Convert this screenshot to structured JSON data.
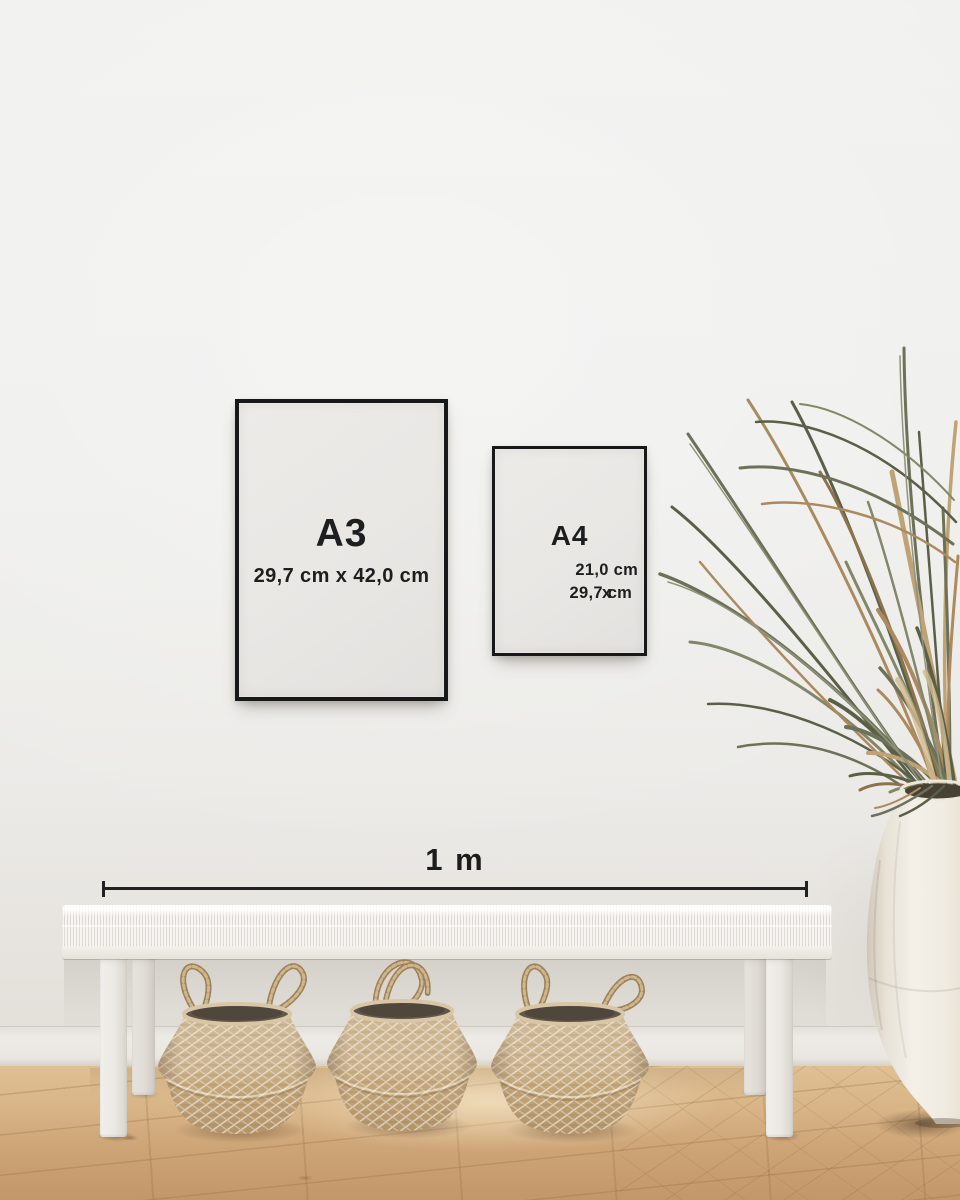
{
  "page": {
    "type": "poster-frame-size-guide-mockup"
  },
  "frames": [
    {
      "label": "A3",
      "dimensions": "29,7 cm x 42,0 cm"
    },
    {
      "label": "A4",
      "dimensions_line1": "21,0 cm x",
      "dimensions_line2": "29,7 cm"
    }
  ],
  "scale": {
    "label": "1 m"
  },
  "scene": {
    "objects": [
      "framed-poster-a3",
      "framed-poster-a4",
      "measurement-scale-bar",
      "white-woven-bench",
      "seagrass-belly-basket-left",
      "seagrass-belly-basket-middle",
      "seagrass-belly-basket-right",
      "dried-palm-plant",
      "white-ceramic-vase",
      "oak-wood-floor",
      "baseboard",
      "white-wall"
    ]
  },
  "colors": {
    "wall": "#efefed",
    "frame_border": "#17181a",
    "paper": "#e9e7e4",
    "text": "#1d1e20",
    "scale_line": "#212121",
    "floor_light": "#dfc094",
    "floor_dark": "#c2986a",
    "basket_light": "#cdb796",
    "basket_dark": "#b3946a",
    "plant_green": "#6d7158",
    "plant_tan": "#b0906a",
    "bench_white": "#f4f2ee",
    "vase_cream": "#f1ede5"
  }
}
